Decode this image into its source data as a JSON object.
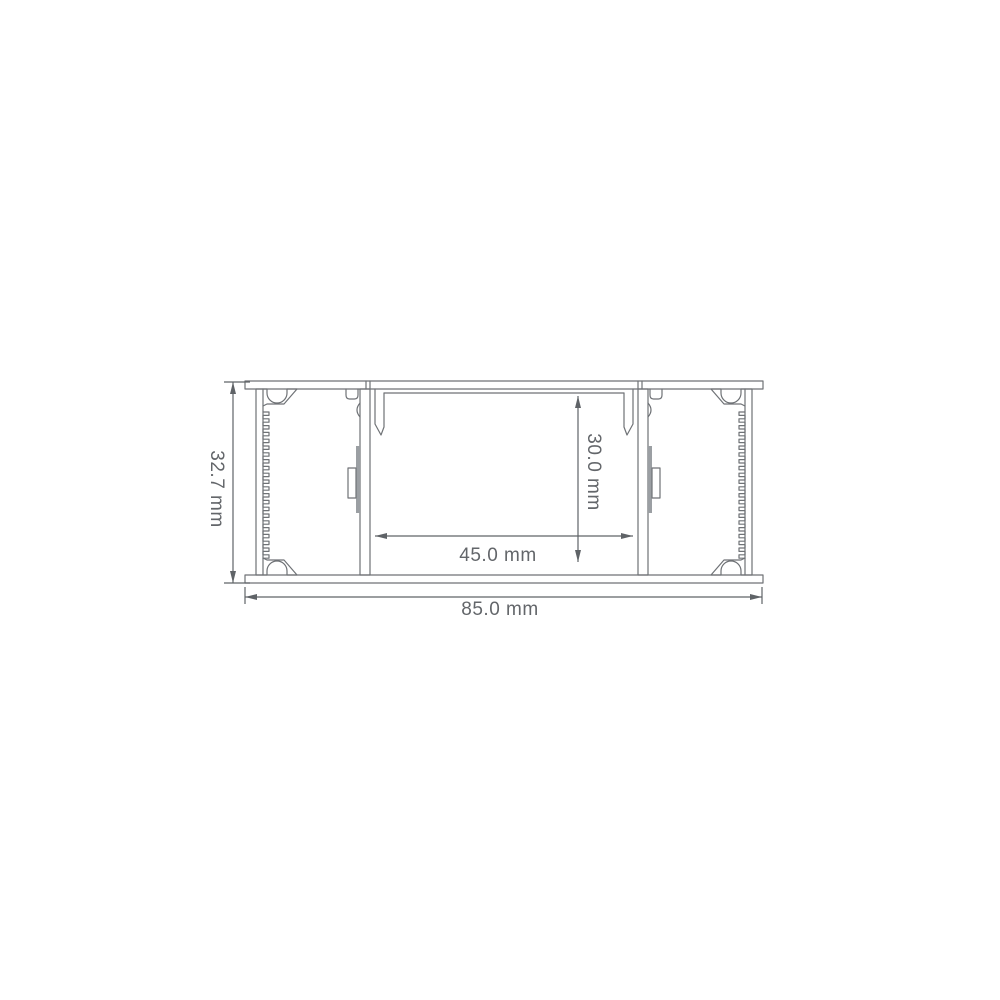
{
  "drawing": {
    "dimensions": {
      "overall_height": {
        "label": "32.7 mm",
        "value": 32.7,
        "unit": "mm"
      },
      "overall_width": {
        "label": "85.0 mm",
        "value": 85.0,
        "unit": "mm"
      },
      "inner_width": {
        "label": "45.0 mm",
        "value": 45.0,
        "unit": "mm"
      },
      "inner_height": {
        "label": "30.0 mm",
        "value": 30.0,
        "unit": "mm"
      }
    },
    "colors": {
      "outline": "#6f7276",
      "dimension_line": "#5f6367",
      "label_text": "#63666a",
      "clip_strip_fill": "#9b9fa3",
      "background": "#ffffff"
    }
  }
}
